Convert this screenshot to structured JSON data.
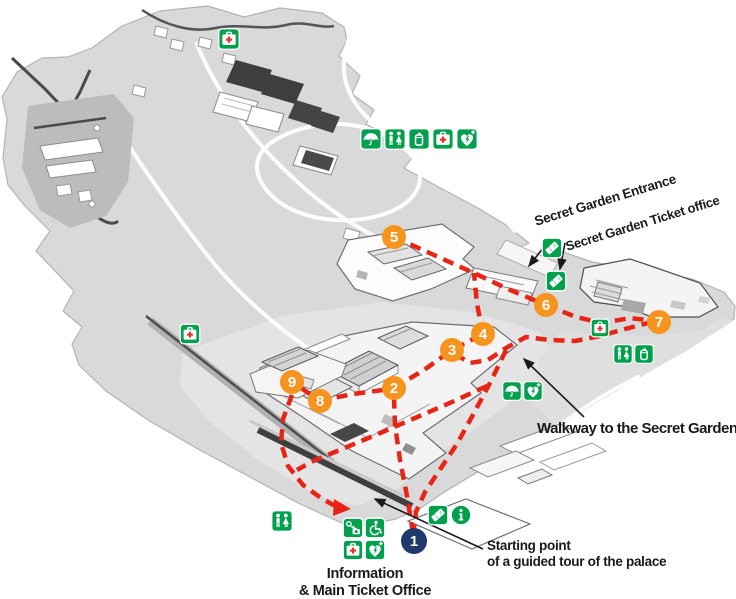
{
  "map_title": "Palace guided tour map",
  "labels": {
    "secret_garden_entrance": "Secret Garden Entrance",
    "secret_garden_ticket_office": "Secret Garden Ticket office",
    "walkway": "Walkway to the Secret Garden",
    "starting_point_line1": "Starting point",
    "starting_point_line2": "of a guided tour of the palace",
    "info_office_line1": "Information",
    "info_office_line2": "& Main Ticket Office"
  },
  "colors": {
    "facility_green": "#00a04c",
    "first_aid_red": "#e8312a",
    "route_red": "#e82417",
    "stop_orange": "#f7941e",
    "start_blue": "#1e3a6d",
    "map_gray": "#d8d9d8",
    "label_black": "#1a1a1a"
  },
  "tour_stops": [
    {
      "label": "1",
      "x": 414,
      "y": 541,
      "style": "start"
    },
    {
      "label": "2",
      "x": 394,
      "y": 388,
      "style": "stop"
    },
    {
      "label": "3",
      "x": 452,
      "y": 350,
      "style": "stop"
    },
    {
      "label": "4",
      "x": 483,
      "y": 334,
      "style": "stop"
    },
    {
      "label": "5",
      "x": 394,
      "y": 237,
      "style": "stop"
    },
    {
      "label": "6",
      "x": 546,
      "y": 305,
      "style": "stop"
    },
    {
      "label": "7",
      "x": 659,
      "y": 322,
      "style": "stop"
    },
    {
      "label": "8",
      "x": 320,
      "y": 401,
      "style": "stop"
    },
    {
      "label": "9",
      "x": 292,
      "y": 382,
      "style": "stop"
    }
  ],
  "facilities": [
    {
      "icon": "first-aid-icon",
      "x": 229,
      "y": 39,
      "size": 22
    },
    {
      "icon": "umbrella-icon",
      "x": 371,
      "y": 139,
      "size": 22
    },
    {
      "icon": "toilets-icon",
      "x": 395,
      "y": 139,
      "size": 22
    },
    {
      "icon": "drink-icon",
      "x": 419,
      "y": 139,
      "size": 22
    },
    {
      "icon": "first-aid-icon",
      "x": 443,
      "y": 139,
      "size": 22
    },
    {
      "icon": "aed-icon",
      "x": 467,
      "y": 139,
      "size": 22
    },
    {
      "icon": "first-aid-icon",
      "x": 190,
      "y": 334,
      "size": 21
    },
    {
      "icon": "ticket-icon",
      "x": 552,
      "y": 248,
      "size": 21
    },
    {
      "icon": "ticket-icon",
      "x": 556,
      "y": 281,
      "size": 21
    },
    {
      "icon": "first-aid-icon",
      "x": 600,
      "y": 328,
      "size": 19
    },
    {
      "icon": "toilets-icon",
      "x": 623,
      "y": 354,
      "size": 20
    },
    {
      "icon": "drink-icon",
      "x": 644,
      "y": 354,
      "size": 20
    },
    {
      "icon": "umbrella-icon",
      "x": 512,
      "y": 391,
      "size": 20
    },
    {
      "icon": "aed-icon",
      "x": 533,
      "y": 391,
      "size": 20
    },
    {
      "icon": "toilets-icon",
      "x": 282,
      "y": 521,
      "size": 22
    },
    {
      "icon": "locker-icon",
      "x": 353,
      "y": 528,
      "size": 21
    },
    {
      "icon": "wheelchair-icon",
      "x": 375,
      "y": 528,
      "size": 21
    },
    {
      "icon": "first-aid-icon",
      "x": 353,
      "y": 550,
      "size": 21
    },
    {
      "icon": "aed-icon",
      "x": 375,
      "y": 550,
      "size": 21
    },
    {
      "icon": "ticket-icon",
      "x": 438,
      "y": 515,
      "size": 21
    },
    {
      "icon": "info-icon",
      "x": 461,
      "y": 515,
      "size": 22
    }
  ],
  "routes": [
    {
      "name": "start-to-stop2",
      "points": [
        [
          413,
          533
        ],
        [
          407,
          496
        ],
        [
          400,
          460
        ],
        [
          395,
          425
        ],
        [
          394,
          398
        ]
      ]
    },
    {
      "name": "stop2-to-stop4",
      "points": [
        [
          394,
          388
        ],
        [
          424,
          370
        ],
        [
          452,
          350
        ],
        [
          483,
          334
        ]
      ]
    },
    {
      "name": "stop4-to-junction",
      "points": [
        [
          483,
          334
        ],
        [
          477,
          304
        ],
        [
          474,
          273
        ]
      ]
    },
    {
      "name": "stop5-to-stop6",
      "points": [
        [
          394,
          237
        ],
        [
          434,
          255
        ],
        [
          474,
          273
        ],
        [
          510,
          290
        ],
        [
          546,
          305
        ]
      ]
    },
    {
      "name": "stop6-to-stop7",
      "points": [
        [
          546,
          305
        ],
        [
          576,
          317
        ],
        [
          602,
          323
        ],
        [
          630,
          318
        ],
        [
          655,
          321
        ]
      ]
    },
    {
      "name": "walkway-line",
      "points": [
        [
          455,
          354
        ],
        [
          470,
          363
        ],
        [
          488,
          360
        ],
        [
          506,
          348
        ],
        [
          526,
          337
        ],
        [
          550,
          340
        ],
        [
          575,
          341
        ],
        [
          600,
          336
        ],
        [
          625,
          329
        ],
        [
          648,
          323
        ]
      ]
    },
    {
      "name": "walkway-to-start",
      "points": [
        [
          506,
          350
        ],
        [
          491,
          381
        ],
        [
          474,
          413
        ],
        [
          457,
          444
        ],
        [
          441,
          468
        ],
        [
          425,
          492
        ],
        [
          416,
          512
        ],
        [
          414,
          528
        ]
      ]
    },
    {
      "name": "branch-to-west",
      "points": [
        [
          487,
          386
        ],
        [
          452,
          402
        ],
        [
          415,
          418
        ],
        [
          378,
          434
        ],
        [
          342,
          449
        ],
        [
          311,
          462
        ],
        [
          297,
          470
        ]
      ]
    },
    {
      "name": "loop-from-stop9",
      "points": [
        [
          292,
          395
        ],
        [
          283,
          419
        ],
        [
          281,
          443
        ],
        [
          288,
          466
        ],
        [
          303,
          485
        ],
        [
          321,
          498
        ],
        [
          337,
          507
        ]
      ]
    },
    {
      "name": "stop2-to-stop8",
      "points": [
        [
          383,
          390
        ],
        [
          353,
          394
        ],
        [
          333,
          398
        ]
      ]
    },
    {
      "name": "stop8-to-stop9",
      "points": [
        [
          310,
          394
        ],
        [
          301,
          388
        ]
      ]
    }
  ]
}
